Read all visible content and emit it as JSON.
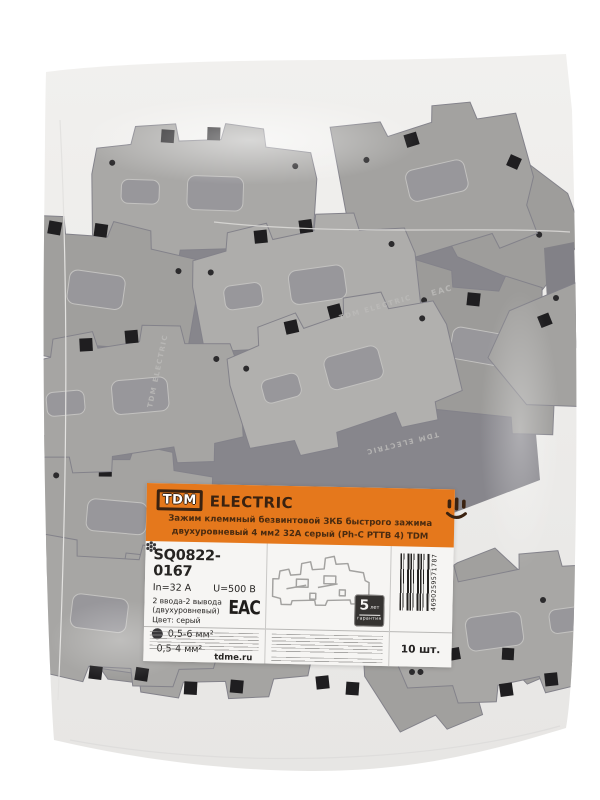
{
  "photo": {
    "background_color": "#ffffff",
    "bag_color": "#eeedeb",
    "block_color": "#a5a4a2",
    "embossed_text": "TDM ELECTRIC",
    "embossed_cert": "EAC"
  },
  "label": {
    "accent_color": "#e5781c",
    "brand": {
      "logo_text": "TDM",
      "brand_name": "ELECTRIC"
    },
    "description_line1": "Зажим клеммный безвинтовой ЗКБ быстрого зажима",
    "description_line2": "двухуровневый 4 мм2 32А серый (Ph-C PTTB 4) TDM",
    "article": "SQ0822-0167",
    "current": "In=32 А",
    "voltage": "U=500 В",
    "io_line": "2 ввода-2 вывода (двухуровневый)",
    "color_line": "Цвет: серый",
    "specs": [
      {
        "icon": "solid-wire-icon",
        "value": "0,5-6 мм²"
      },
      {
        "icon": "stranded-wire-icon",
        "value": "0,5-4 мм²"
      }
    ],
    "cert_mark": "EAC",
    "warranty": {
      "number": "5",
      "unit": "лет",
      "caption": "гарантия"
    },
    "barcode_number": "4690259571787",
    "quantity": "10 шт.",
    "website": "tdme.ru"
  }
}
